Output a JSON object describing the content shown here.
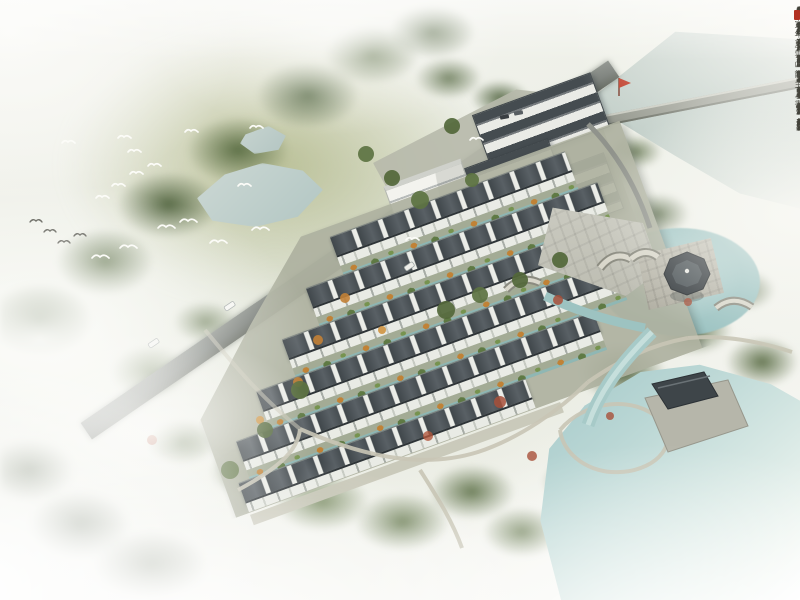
{
  "scene": {
    "kind": "aerial architectural rendering",
    "style": "Chinese Jiangnan traditional residential development with water garden",
    "mood": "misty watercolor edges"
  },
  "calligraphy": {
    "title_column": "庚寅年夏",
    "columns": [
      "東南形勝三吳都會",
      "錢塘自古繁華煙柳",
      "畫橋風簾翠幕參差",
      "十萬人家雲樹繞堤",
      "沙怒濤卷霜雪天塹",
      "無涯市列珠璣戶盈",
      "羅綺競豪奢重湖疊",
      "巘清嘉有三秋桂子"
    ],
    "signature": "雲山館主人書",
    "ink_color": "#42423a",
    "seal_color": "#b23122"
  },
  "palette": {
    "mist_white": "#fbfbf8",
    "foliage_green": "#54683c",
    "meadow_green": "#b7bd92",
    "roof_gray": "#454c50",
    "wall_white": "#eceee9",
    "water_teal": "#a3c8c9",
    "pond_blue": "#bccfcc",
    "road_gray": "#767b76",
    "autumn_orange": "#c08236",
    "autumn_red": "#a8503a"
  },
  "features": {
    "townhouse_rows": 6,
    "north_buildings": 5,
    "ponds": 2,
    "lakes": 2,
    "stone_bridges": 3,
    "island_pavilion": "octagonal pavilion on square stone platform in round pond",
    "waterside_hall": 1,
    "white_birds": 18,
    "dark_birds": 4,
    "cars": 5
  }
}
